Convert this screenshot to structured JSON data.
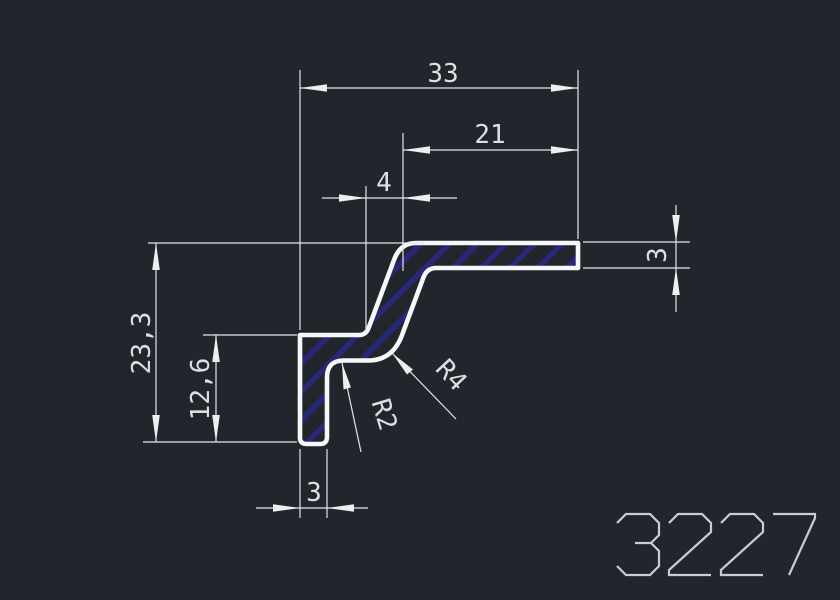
{
  "drawing": {
    "part_number": "3227",
    "dimensions": {
      "overall_width": "33",
      "flange_length": "21",
      "slant_run": "4",
      "overall_height": "23,3",
      "leg_height": "12,6",
      "leg_thickness": "3",
      "flange_thickness": "3",
      "fillet_large": "R4",
      "fillet_small": "R2"
    },
    "colors": {
      "background": "#22252c",
      "profile_outline": "#f5f7f8",
      "hatch_line": "#28287a",
      "dimension_line": "#e3e6e8",
      "dimension_text": "#dcdfe1",
      "part_number_text": "#c9cdd1"
    }
  }
}
